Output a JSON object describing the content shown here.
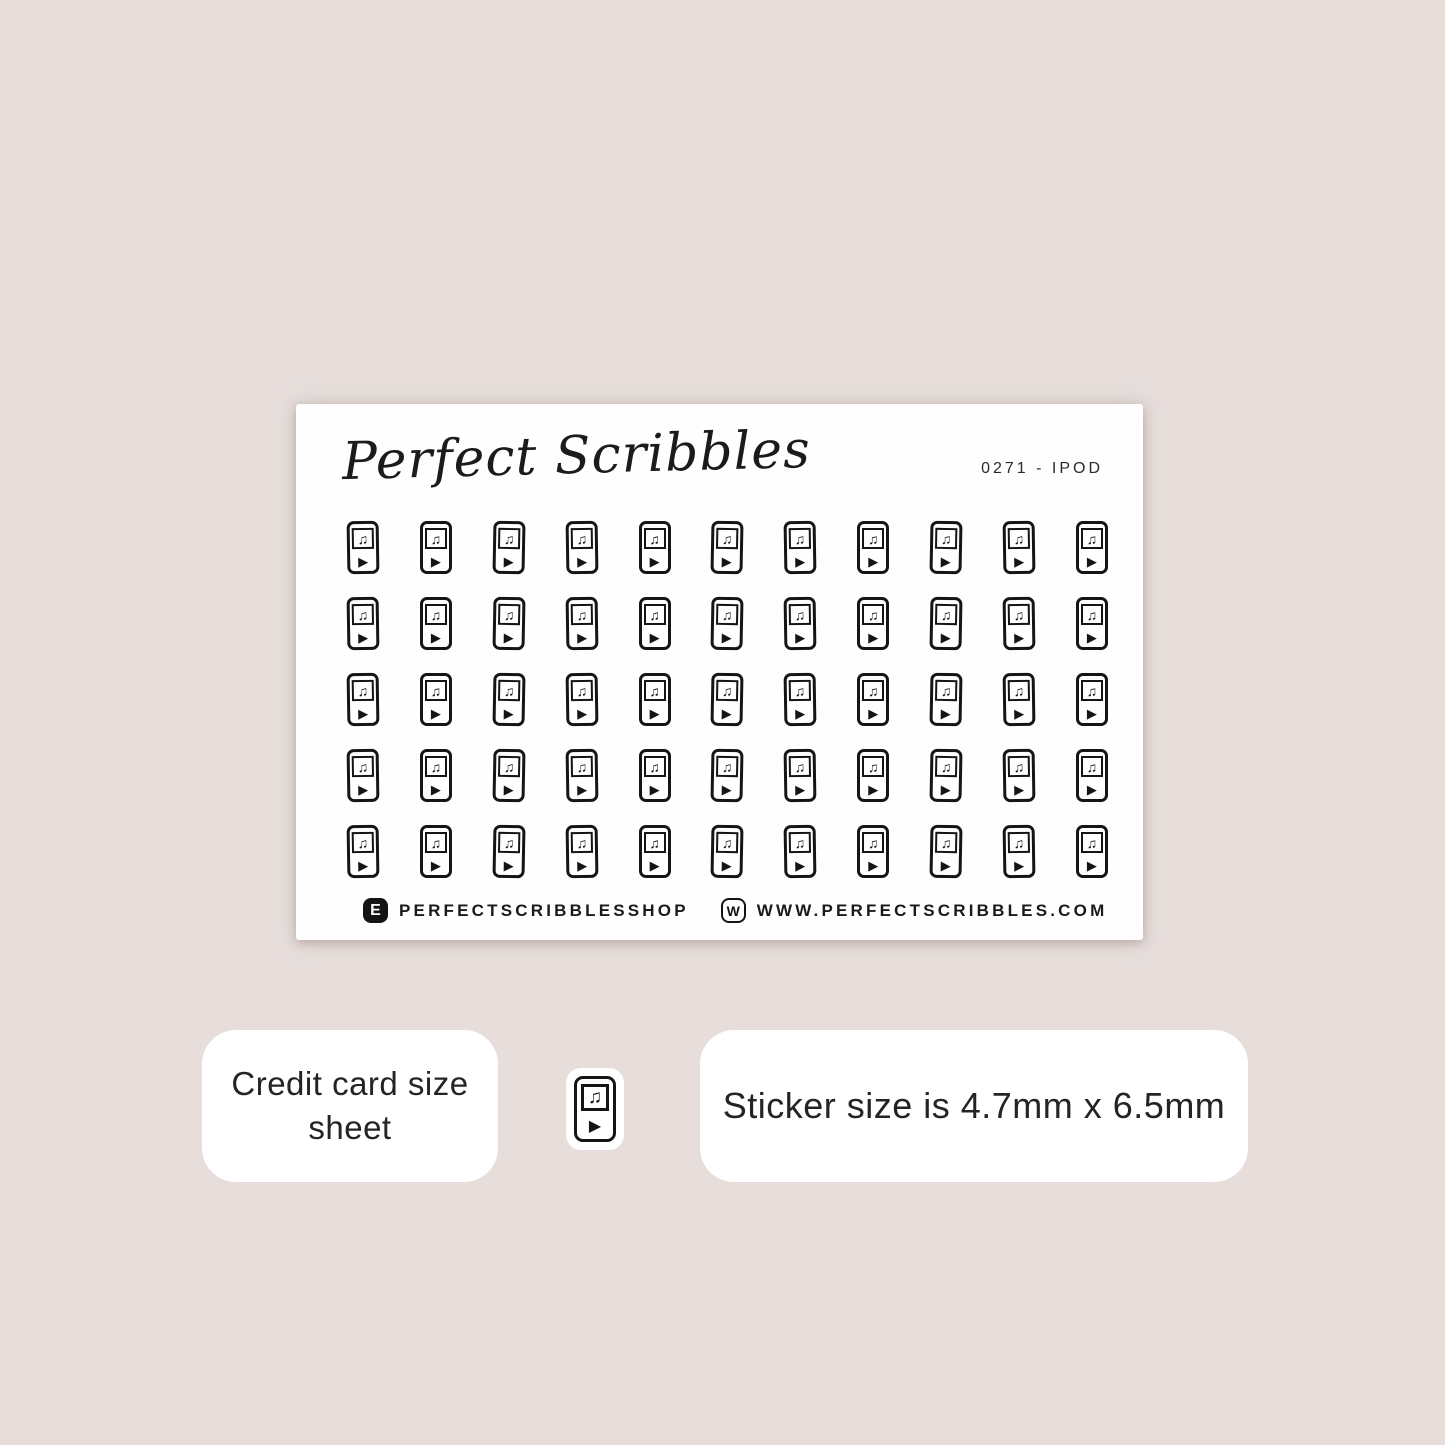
{
  "sheet": {
    "brand_script": "Perfect Scribbles",
    "sku": "0271 - IPOD",
    "grid": {
      "rows": 5,
      "columns": 11,
      "icon": "ipod-music-player-icon",
      "total_stickers": 55
    },
    "footer": {
      "etsy_badge_letter": "E",
      "etsy_handle": "PERFECTSCRIBBLESSHOP",
      "web_badge_letter": "W",
      "website": "WWW.PERFECTSCRIBBLES.COM"
    }
  },
  "info": {
    "left_box_line1": "Credit card size",
    "left_box_line2": "sheet",
    "chip_icon": "ipod-music-player-icon",
    "right_box_text": "Sticker size is 4.7mm x 6.5mm"
  },
  "icon_glyphs": {
    "music_note": "♫",
    "play": "▶"
  },
  "colors": {
    "background": "#e7dedc",
    "sheet": "#fefefe",
    "ink": "#151515",
    "info_box": "#ffffff"
  }
}
